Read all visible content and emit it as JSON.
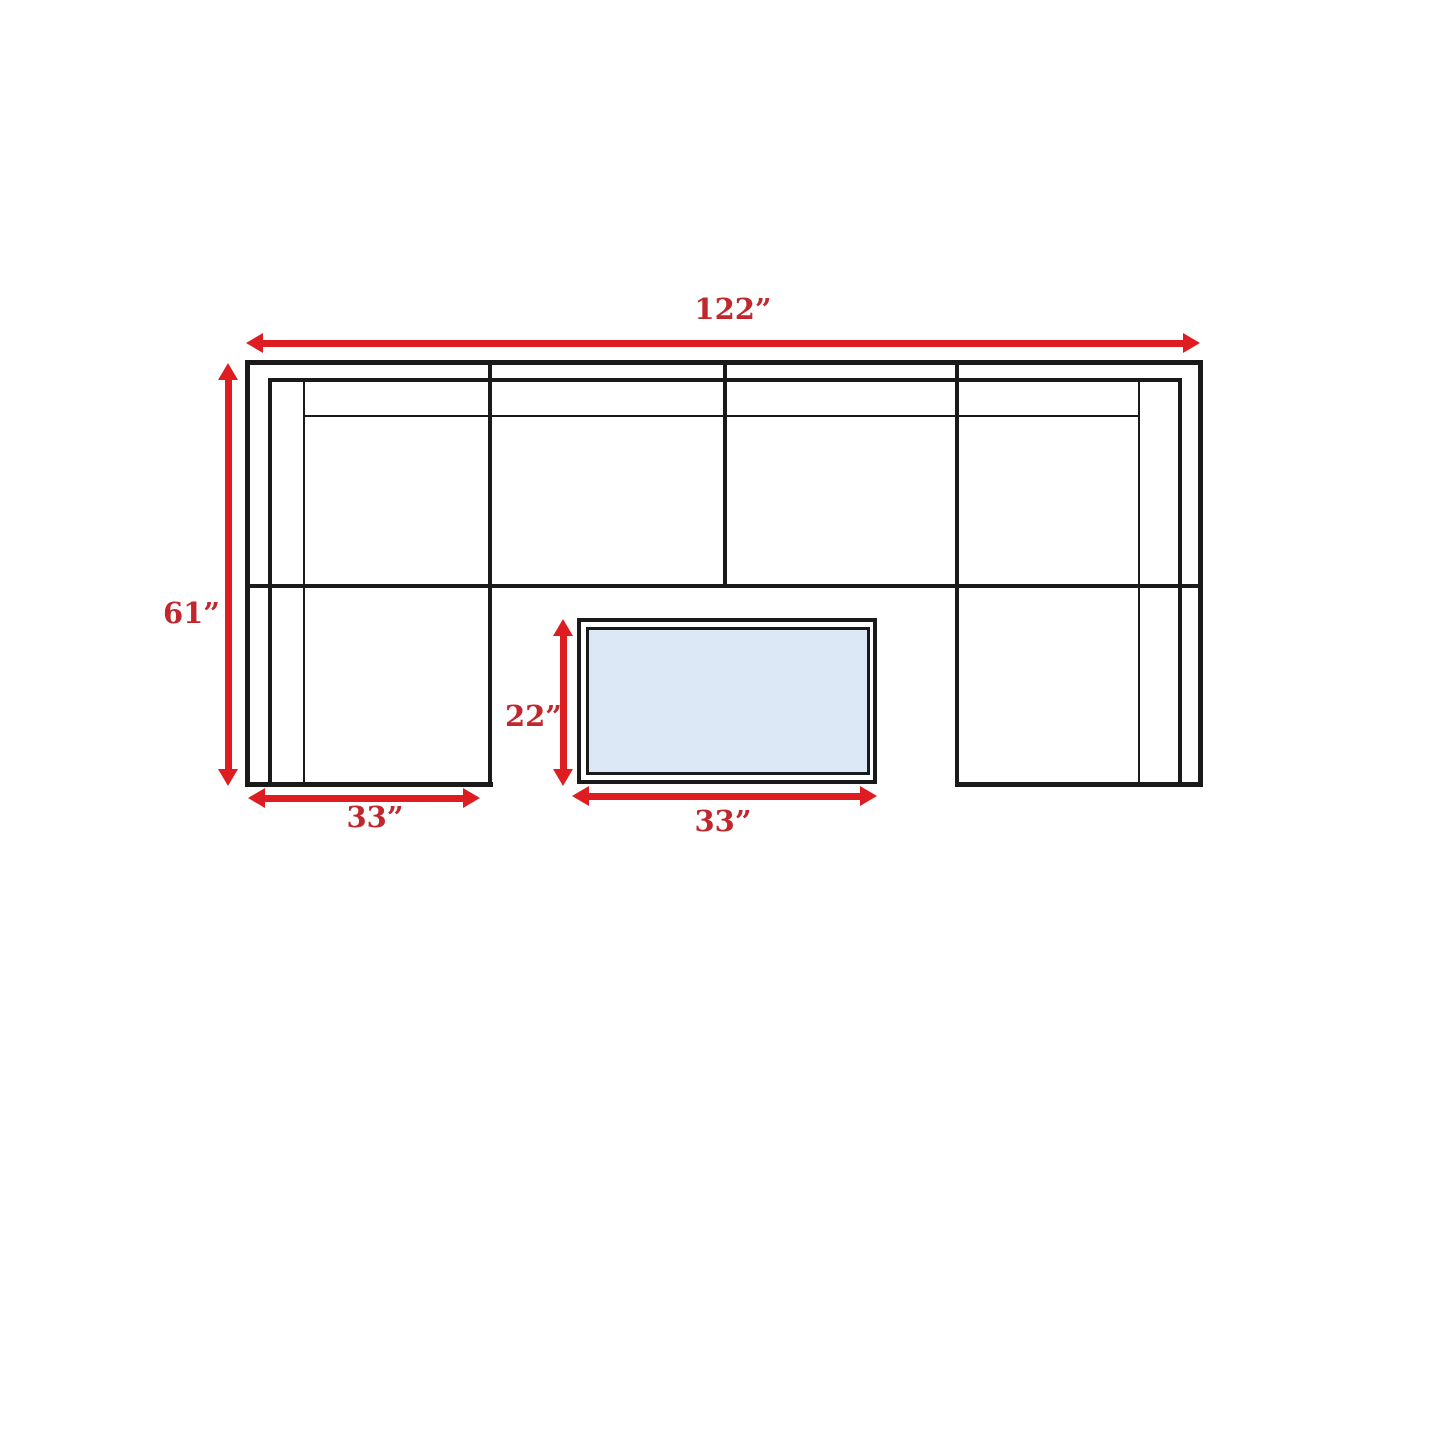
{
  "diagram": {
    "type": "sectional-sofa-dimension-diagram",
    "dimensions": {
      "overall_width": "122”",
      "overall_depth": "61”",
      "left_chaise_width": "33”",
      "coffee_table_depth": "22”",
      "coffee_table_width": "33”"
    },
    "colors": {
      "arrow_red": "#dd1d22",
      "label_red": "#c1272d",
      "outline_black": "#1a1a1a",
      "table_fill_blue": "#dce8f5",
      "background": "#ffffff"
    }
  }
}
